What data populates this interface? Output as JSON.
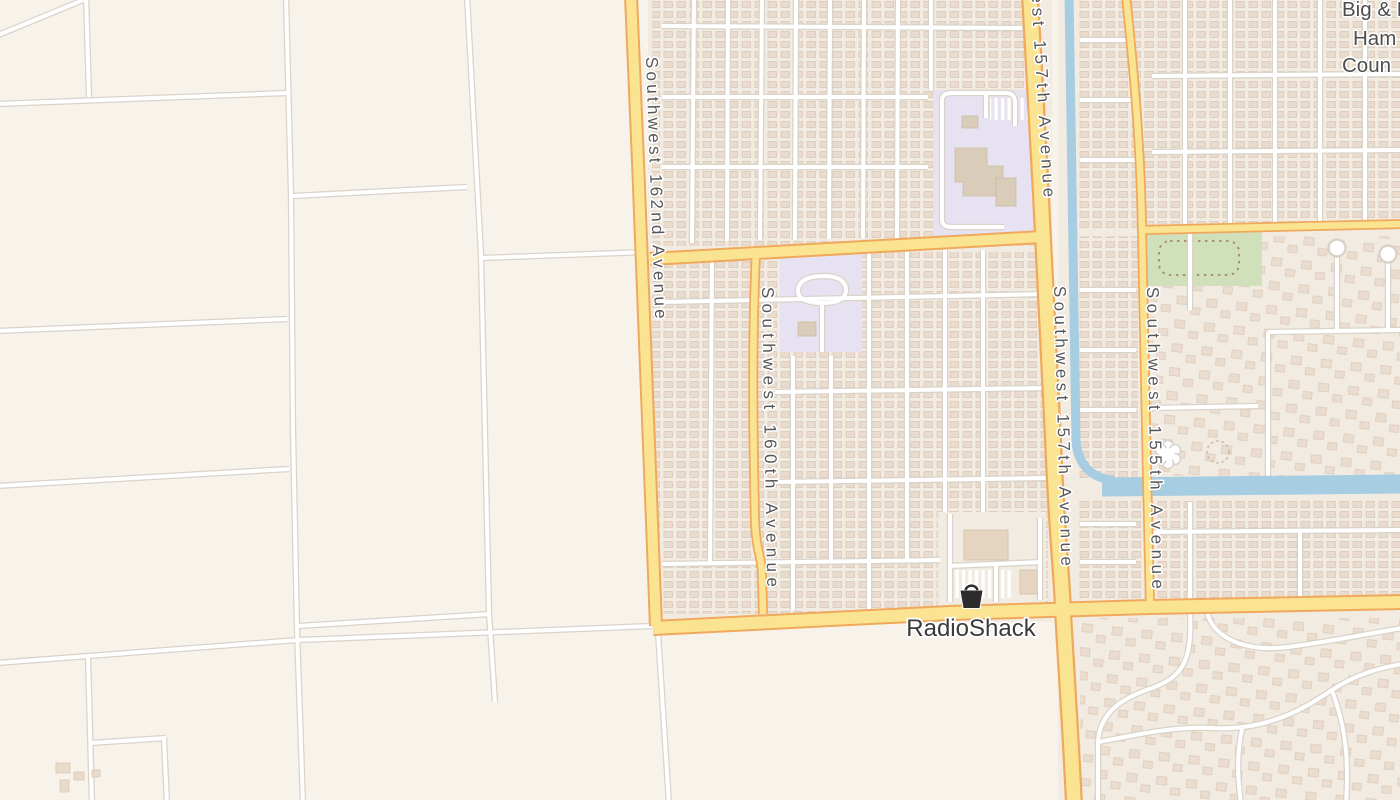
{
  "map": {
    "street_labels": {
      "sw162nd": "Southwest 162nd Avenue",
      "sw160th": "Southwest 160th Avenue",
      "sw157th_top": "Southwest 157th Avenue",
      "sw157th": "Southwest 157th Avenue",
      "sw155th": "Southwest 155th Avenue"
    },
    "poi": {
      "label": "RadioShack",
      "icon": "shopping-basket-icon"
    },
    "corner_label": {
      "line1": "Big & Lit",
      "line2": "Ham",
      "line3": "Coun"
    },
    "colors": {
      "rural": "#f8f3ea",
      "residential": "#f1ebe2",
      "road_fill": "#fbe491",
      "road_casing": "#f0a95c",
      "street_fill": "#ffffff",
      "street_casing": "#d9d3ca",
      "water": "#a6cde1",
      "park": "#cfe0bb",
      "park_trail": "#a8916f",
      "school": "#e7e2f1",
      "label_text": "#575757",
      "poi_text": "#3b3b3b"
    }
  }
}
